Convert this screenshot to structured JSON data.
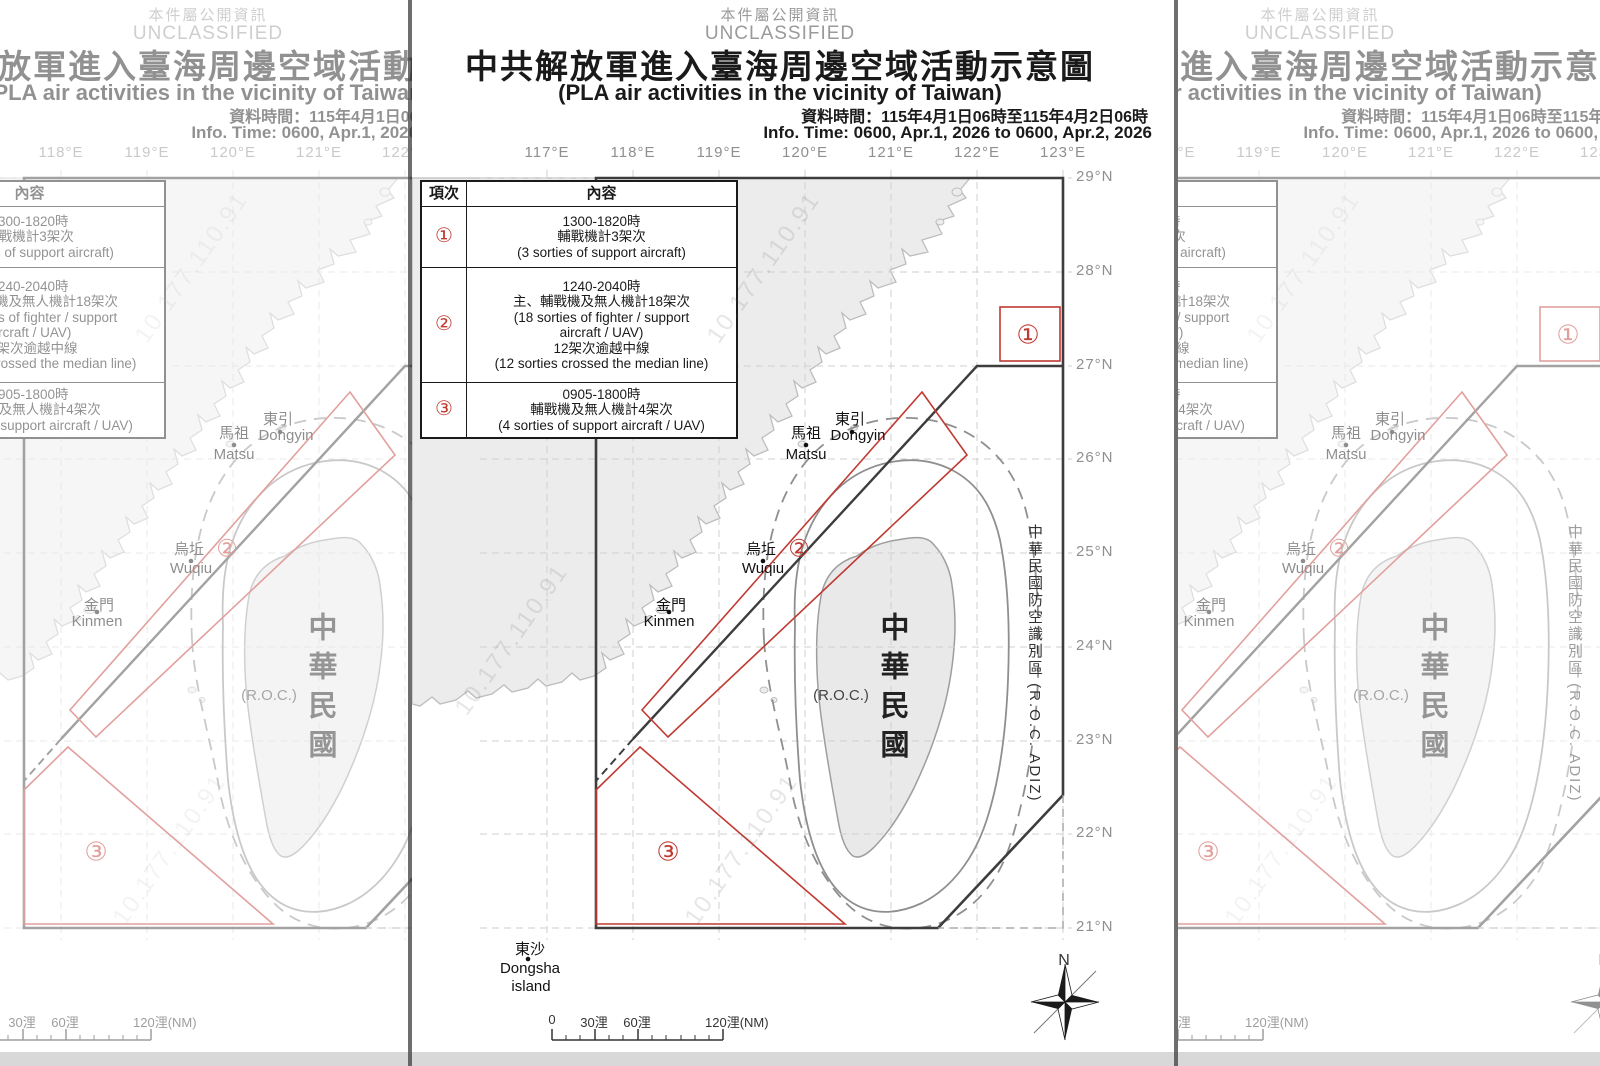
{
  "colors": {
    "accent_red": "#c03a32",
    "frame_dark": "#3d3d3d",
    "land_fill": "#ececec",
    "muted_gray": "#8f8f8f"
  },
  "classification": {
    "zh": "本件屬公開資訊",
    "en": "UNCLASSIFIED"
  },
  "title": {
    "zh": "中共解放軍進入臺海周邊空域活動示意圖",
    "en": "(PLA air activities in the vicinity of Taiwan)"
  },
  "info_time": {
    "zh": "資料時間：115年4月1日06時至115年4月2日06時",
    "en": "Info. Time: 0600, Apr.1, 2026 to 0600,  Apr.2, 2026"
  },
  "legend_table": {
    "col1_header": "項次",
    "col2_header": "內容",
    "rows": [
      {
        "item": "①",
        "lines": [
          "1300-1820時",
          "輔戰機計3架次",
          "(3 sorties of support aircraft)"
        ]
      },
      {
        "item": "②",
        "lines": [
          "1240-2040時",
          "主、輔戰機及無人機計18架次",
          "(18 sorties of fighter / support",
          "aircraft / UAV)",
          "12架次逾越中線",
          "(12 sorties crossed the median line)"
        ]
      },
      {
        "item": "③",
        "lines": [
          "0905-1800時",
          "輔戰機及無人機計4架次",
          "(4 sorties of support aircraft / UAV)"
        ]
      }
    ]
  },
  "axes": {
    "longitudes": [
      "117°E",
      "118°E",
      "119°E",
      "120°E",
      "121°E",
      "122°E",
      "123°E"
    ],
    "latitudes": [
      "29°N",
      "28°N",
      "27°N",
      "26°N",
      "25°N",
      "24°N",
      "23°N",
      "22°N",
      "21°N"
    ]
  },
  "places": {
    "dongyin": {
      "zh": "東引",
      "en": "Dongyin"
    },
    "matsu": {
      "zh": "馬祖",
      "en": "Matsu"
    },
    "wuqiu": {
      "zh": "烏坵",
      "en": "Wuqiu"
    },
    "kinmen": {
      "zh": "金門",
      "en": "Kinmen"
    },
    "dongsha": {
      "zh": "東沙",
      "en_line1": "Dongsha",
      "en_line2": "island"
    },
    "taiwan": {
      "zh": "中華民國",
      "en": "(R.O.C.)"
    }
  },
  "adiz_label": "中華民國防空識別區 (R.O.C. ADIZ)",
  "region_markers": {
    "r1": "①",
    "r2": "②",
    "r3": "③"
  },
  "compass": {
    "north": "N"
  },
  "scale_bar": {
    "labels": [
      "0",
      "30浬",
      "60浬",
      "120浬(NM)"
    ]
  },
  "watermark": "10.177.110.91"
}
